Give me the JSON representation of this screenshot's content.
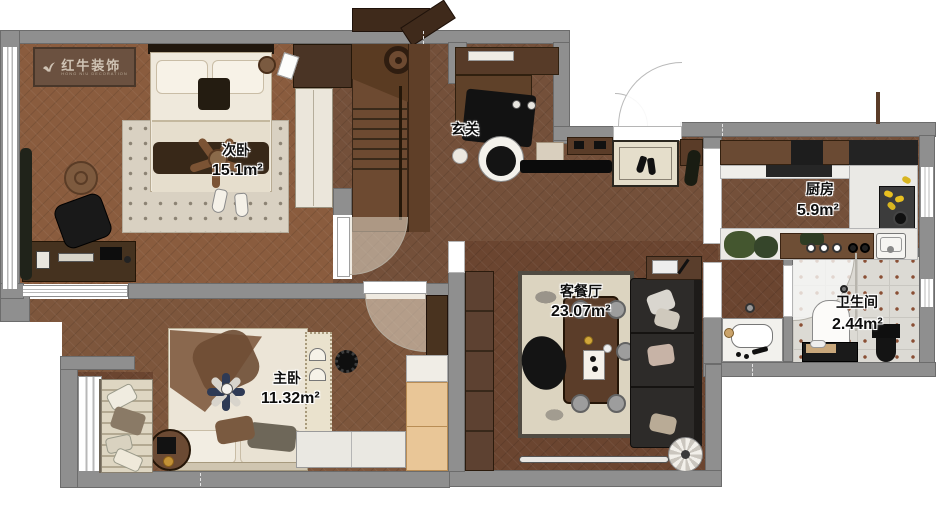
{
  "logo": {
    "title": "红牛装饰",
    "subtitle": "HONG NIU DECORATION"
  },
  "rooms": {
    "secondary_bedroom": {
      "label": "次卧",
      "area": "15.1m²"
    },
    "entry": {
      "label": "玄关"
    },
    "kitchen": {
      "label": "厨房",
      "area": "5.9m²"
    },
    "living_dining": {
      "label": "客餐厅",
      "area": "23.07m²"
    },
    "bathroom": {
      "label": "卫生间",
      "area": "2.44m²"
    },
    "master_bedroom": {
      "label": "主卧",
      "area": "11.32m²"
    }
  },
  "colors": {
    "wall": "#8f8f8f",
    "wood": "#74503a",
    "accent": "#5a3c28"
  }
}
